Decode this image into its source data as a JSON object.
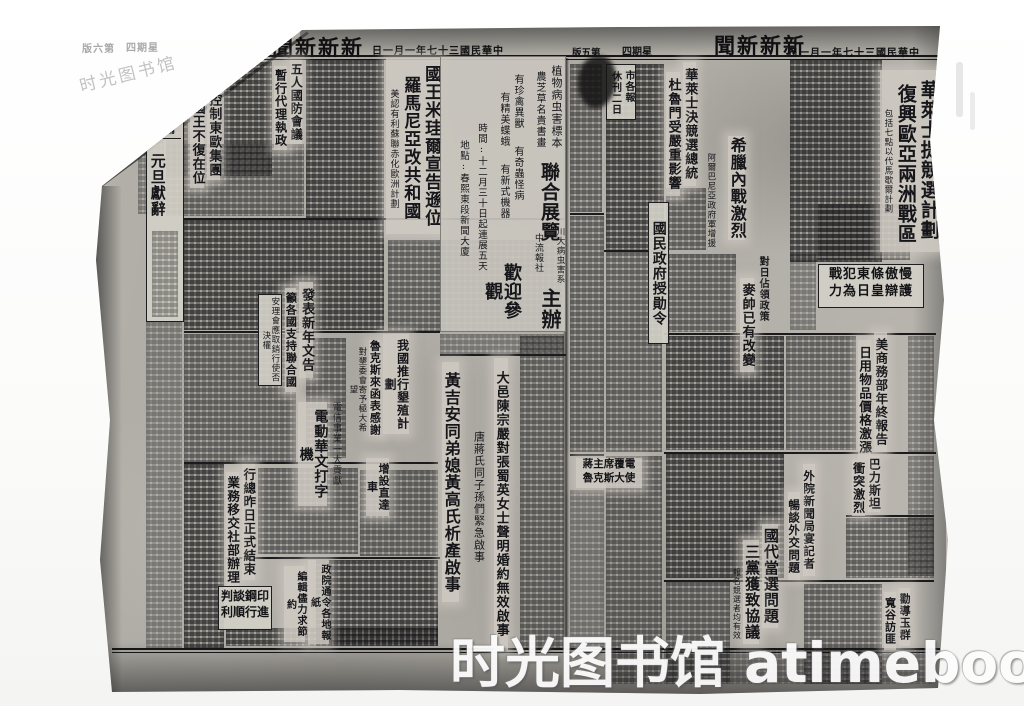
{
  "watermarks": {
    "corner": "时光图书馆",
    "footer": "时光图书馆 atimebook.com"
  },
  "left_page": {
    "masthead": {
      "edition": "版六第",
      "weekday": "四期星",
      "title": "聞新新新",
      "date": "日一月一年七十三國民華中"
    },
    "comet": {
      "title": "新慧星"
    },
    "soviet": {
      "line1": "蘇聯控制東歐集團",
      "line2": "五國國王不復在位"
    },
    "defense": {
      "line1": "五人國防會議",
      "line2": "暫行代理執政"
    },
    "king": {
      "line1": "國王米珪爾宣告遜位",
      "line2": "羅馬尼亞改共和國",
      "sub": "美認有利蘇聯赤化歐洲計劃"
    },
    "editorial": {
      "tag": "社論",
      "title": "元旦獻辭"
    },
    "newyear": {
      "line1": "發表新年文告",
      "line2": "籲各國支持聯合國",
      "inset": "安理會應取銷行使否決權"
    },
    "reclamation": {
      "line1": "我國推行墾殖計劃",
      "line2": "魯克斯來函表感謝",
      "sub": "對墾委會寄予極大希望"
    },
    "typewriter": {
      "kicker": "電信事業一大貢獻",
      "title": "電動華文打字機"
    },
    "express": {
      "title": "增設直達車"
    },
    "cnrra": {
      "line1": "行總昨日正式結束",
      "line2": "業務移交社部辦理"
    },
    "press_order": {
      "line1": "政院通令各地報紙",
      "line2": "編輯儘力求節約"
    },
    "notice_huang": {
      "text": "黃吉安同弟媳黃高氏析產啟事"
    },
    "notice_tang": {
      "text": "唐蔣氏同子孫們緊急啟事"
    },
    "notice_dayi": {
      "text": "大邑陳宗嚴對張蜀英女士聲明婚約無效啟事"
    },
    "brief_box": {
      "line1": "判談鋼印",
      "line2": "利順行進"
    },
    "expo_ad": {
      "col1": "植物病虫害標本",
      "col2": "農芝草名貴書畫",
      "headline1": "聯合展覽",
      "feature1": "有珍禽異獸",
      "feature2": "有精美蝶蛾",
      "feature3": "有奇蟲怪病",
      "feature4": "有新式機器",
      "time": "時間:十二月三十日起連展五天",
      "place": "地點:春熙東段新聞大廈",
      "headline2": "歡迎參觀",
      "org1": "川大病虫害系",
      "org2": "中流報社",
      "host": "主辦"
    }
  },
  "right_page": {
    "masthead": {
      "edition": "版五第",
      "weekday": "四期星",
      "title": "聞新新新",
      "date": "日一月一年七十三國民華中"
    },
    "wallace_plan": {
      "line1": "華萊士提競選計劃",
      "line2": "復興歐亞兩洲戰區",
      "sub": "包括七點以代馬歇爾計劃"
    },
    "wallace_run": {
      "line1": "華萊士決競選總統",
      "line2": "杜魯門受嚴重影響"
    },
    "greece": {
      "title": "希臘內戰激烈",
      "sub": "阿爾巴尼亞政府軍增援"
    },
    "medal": {
      "title": "國民政府授勛令"
    },
    "japan_policy": {
      "line1": "對日佔領政策",
      "line2": "麥帥已有改變"
    },
    "tojo": {
      "line1": "戰犯東條傲慢",
      "line2": "力為日皇辯護"
    },
    "commerce": {
      "line1": "美商務部年終報告",
      "line2": "日用物品價格激漲"
    },
    "palestine": {
      "line1": "巴力斯坦",
      "line2": "衝突激烈"
    },
    "banquet": {
      "line1": "外院新聞局宴記者",
      "line2": "暢談外交問題"
    },
    "delegates": {
      "line1": "國代當選問題",
      "line2": "三黨獲致協議",
      "sub": "報名競選者均有效"
    },
    "persuade": {
      "line1": "勸導玉群",
      "line2": "寬谷訪匪"
    },
    "holiday_box": {
      "line1": "市各報",
      "line2": "休刊二日"
    },
    "jiang_box": {
      "line1": "蔣主席覆電",
      "line2": "魯克斯大使"
    }
  }
}
